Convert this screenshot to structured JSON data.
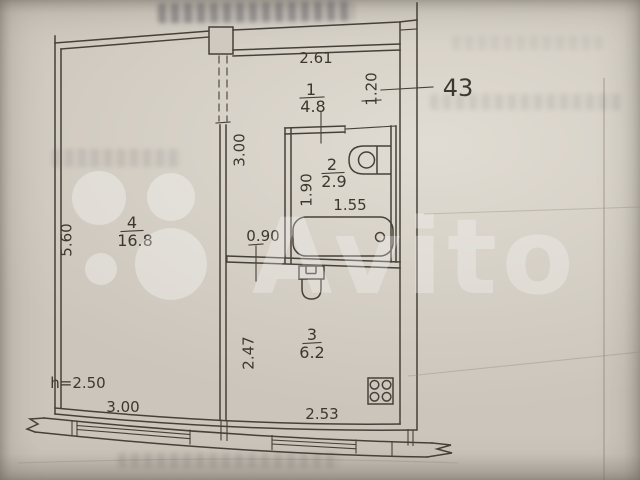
{
  "plan": {
    "apartment_number": "43",
    "ceiling_height_label": "h=2.50",
    "rooms": {
      "hall": {
        "number": "1",
        "area": "4.8"
      },
      "bathroom": {
        "number": "2",
        "area": "2.9"
      },
      "kitchen": {
        "number": "3",
        "area": "6.2"
      },
      "living_room": {
        "number": "4",
        "area": "16.8"
      }
    },
    "dimensions": {
      "hall_width_top": "2.61",
      "entry_depth": "1.20",
      "hall_length": "3.00",
      "passage_width": "0.90",
      "bathroom_length": "1.90",
      "bathtub_length": "1.55",
      "living_room_length": "5.60",
      "living_room_width": "3.00",
      "kitchen_length": "2.47",
      "kitchen_width": "2.53"
    }
  },
  "watermark": {
    "text": "Avito"
  },
  "colors": {
    "paper": "#cbc5bb",
    "ink": "#46403a",
    "watermark": "#ffffff"
  }
}
